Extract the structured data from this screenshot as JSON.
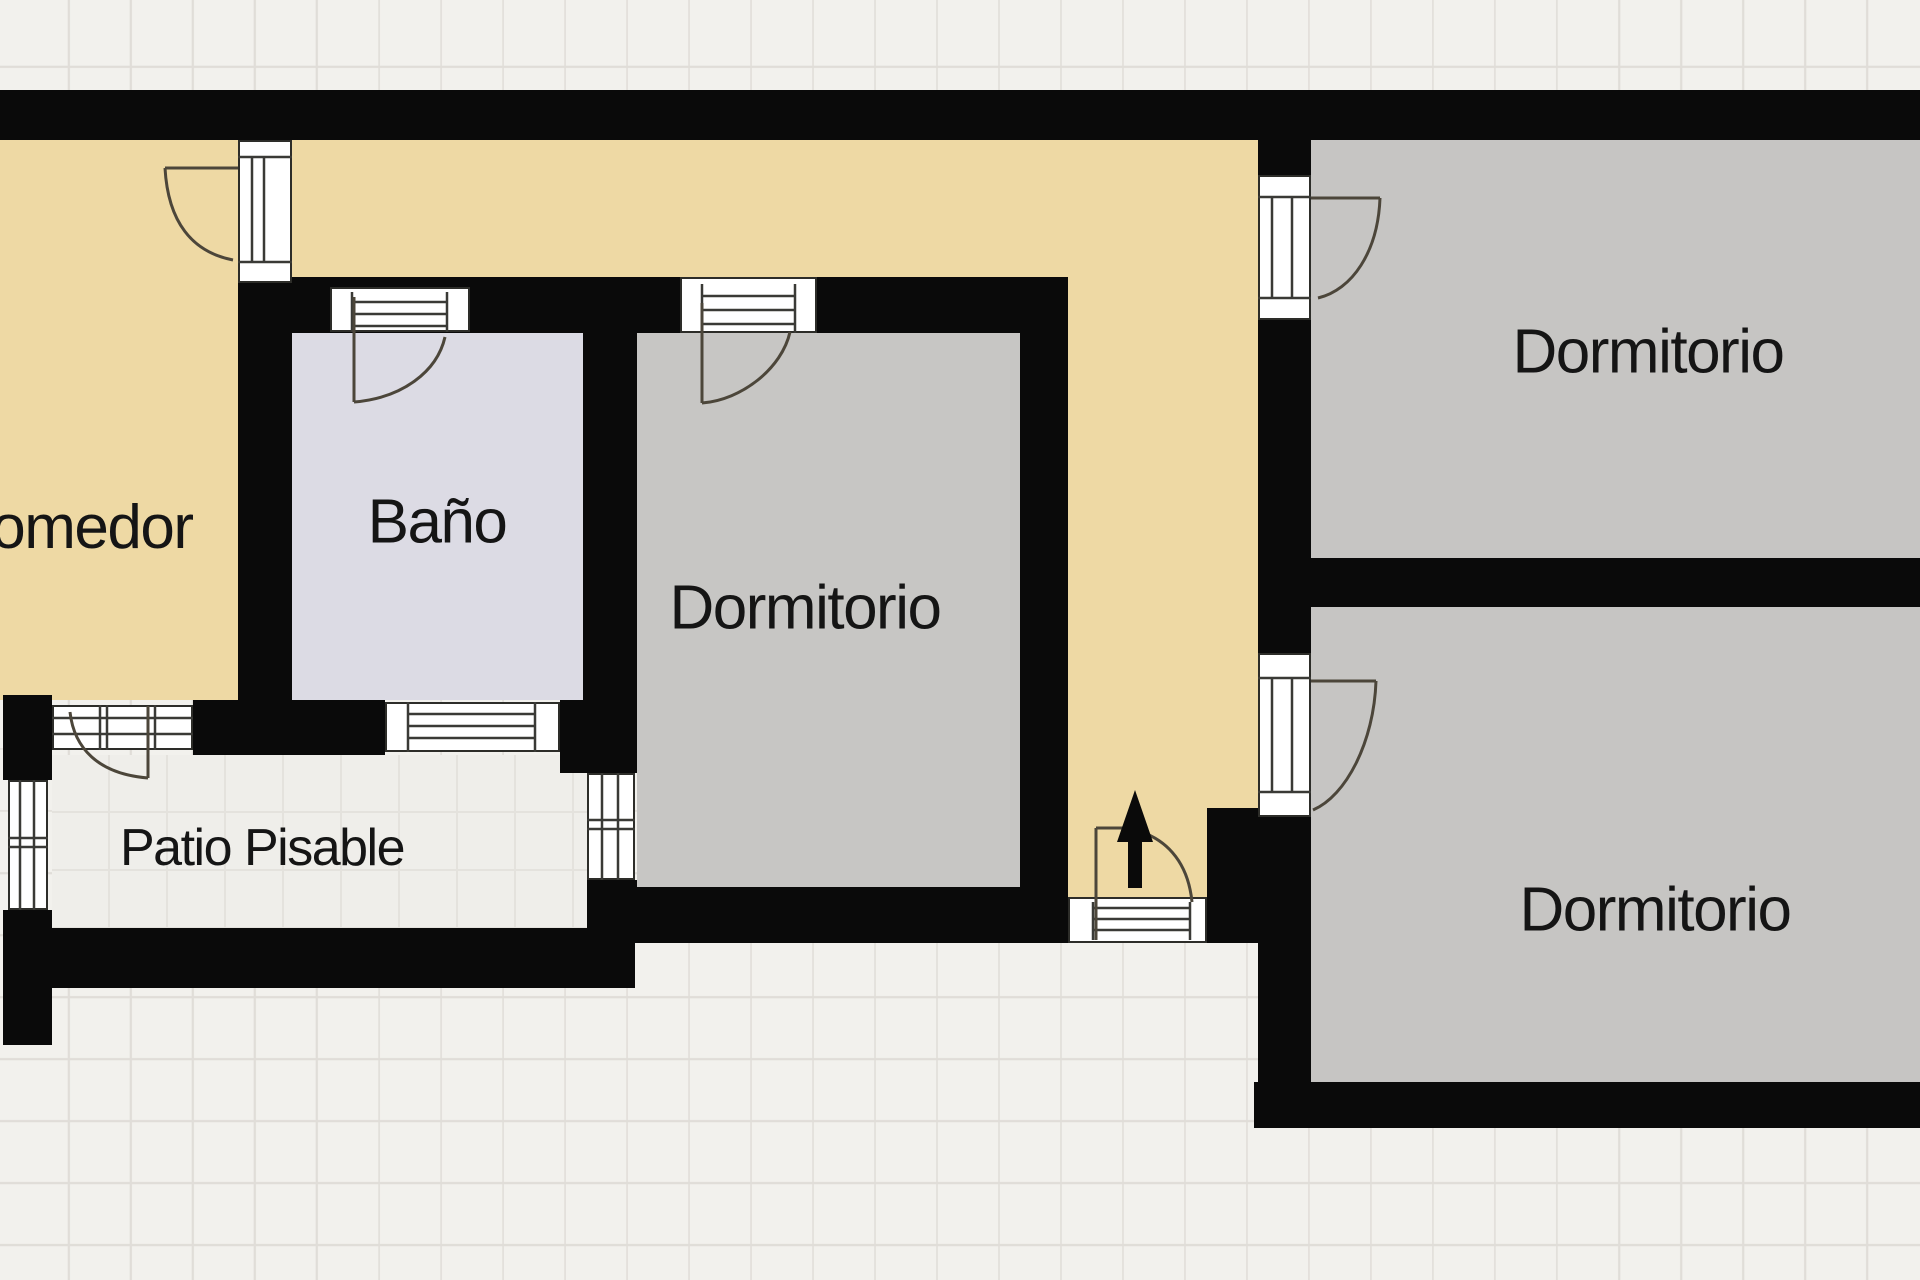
{
  "plan": {
    "type": "floor-plan",
    "language": "es",
    "rooms": [
      {
        "id": "comedor",
        "label": "Comedor",
        "note": "label partially cut off at left edge"
      },
      {
        "id": "bano",
        "label": "Baño"
      },
      {
        "id": "dormitorio-centro",
        "label": "Dormitorio"
      },
      {
        "id": "dormitorio-superior-derecha",
        "label": "Dormitorio"
      },
      {
        "id": "dormitorio-inferior-derecha",
        "label": "Dormitorio"
      },
      {
        "id": "patio",
        "label": "Patio Pisable"
      }
    ],
    "colors": {
      "wall": "#0a0a0a",
      "hallway": "#eed9a4",
      "bathroom": "#dcdbe4",
      "bedroom": "#c7c6c4",
      "bedroom_right": "#c6c5c3",
      "patio": "#efeeea",
      "outside": "#f2f1ed",
      "door_frame": "#ffffff",
      "symbol_stroke": "#4c463a",
      "label_color": "#151515"
    },
    "icons": {
      "entrance_arrow": "up-arrow",
      "doors": "quarter-circle-swing",
      "windows": "mullioned-frame"
    }
  }
}
